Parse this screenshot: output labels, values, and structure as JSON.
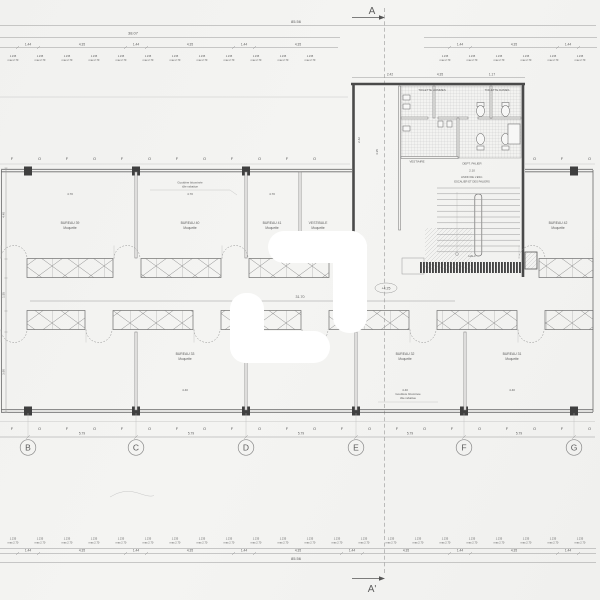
{
  "colors": {
    "paper": "#f3f2f0",
    "line": "#8f8f8f",
    "wall": "#4a4a4a",
    "text": "#5c5c5c",
    "hatch": "#bdbdbd",
    "watermark": "#ffffff"
  },
  "section_markers": {
    "top": "A",
    "bottom": "A'"
  },
  "grid": {
    "letters": [
      "B",
      "C",
      "D",
      "E",
      "F",
      "G"
    ],
    "bay_dimension": "5.79"
  },
  "facade": {
    "panel_letters": [
      "F",
      "O"
    ]
  },
  "dimensions": {
    "overall": "85.56",
    "partial_top": "38.07",
    "corridor_length": "31.70",
    "pier": "1.44",
    "window": "4.35",
    "cluster_line1": "1.235",
    "cluster_line2": "max 2.70",
    "room_width_top": "4.70",
    "room_width_bottom": "4.40",
    "left_side": [
      "4.40",
      "1.55",
      "3.90"
    ],
    "block_top": [
      "2.42",
      "4.35",
      "1.17"
    ],
    "block_inner": [
      "2.42",
      "4.35"
    ],
    "stair_width": "2.10",
    "level_marker": "+4.25"
  },
  "rooms": {
    "top_row": [
      {
        "label": "BUREAU 39",
        "floor": "Moquette"
      },
      {
        "label": "BUREAU 40",
        "floor": "Moquette"
      },
      {
        "label": "BUREAU 41",
        "floor": "Moquette"
      },
      {
        "label": "VESTIBULE",
        "floor": "Moquette"
      },
      {
        "label": "BUREAU 42",
        "floor": "Moquette"
      }
    ],
    "bottom_row": [
      {
        "label": "BUREAU 33",
        "floor": "Moquette"
      },
      {
        "label": "BUREAU 32",
        "floor": "Moquette"
      },
      {
        "label": "BUREAU 31",
        "floor": "Moquette"
      }
    ]
  },
  "sanitary_block": {
    "room_left": "TOILETTE HOMMES",
    "room_right": "TOILETTE DAMES",
    "storage": "VESTIAIRE",
    "landing": "DEPT. PALIER",
    "stair_note_1": "LIMON DE L'ESC.",
    "stair_note_2": "ESCALIER ET DES PALIERS",
    "hall": "HALL"
  },
  "annotations": {
    "gutter_top_1": "Gouttière bituminée",
    "gutter_top_2": "tôle rabattue",
    "gutter_bottom_1": "Gouttière bituminée",
    "gutter_bottom_2": "tôle rabattue"
  }
}
